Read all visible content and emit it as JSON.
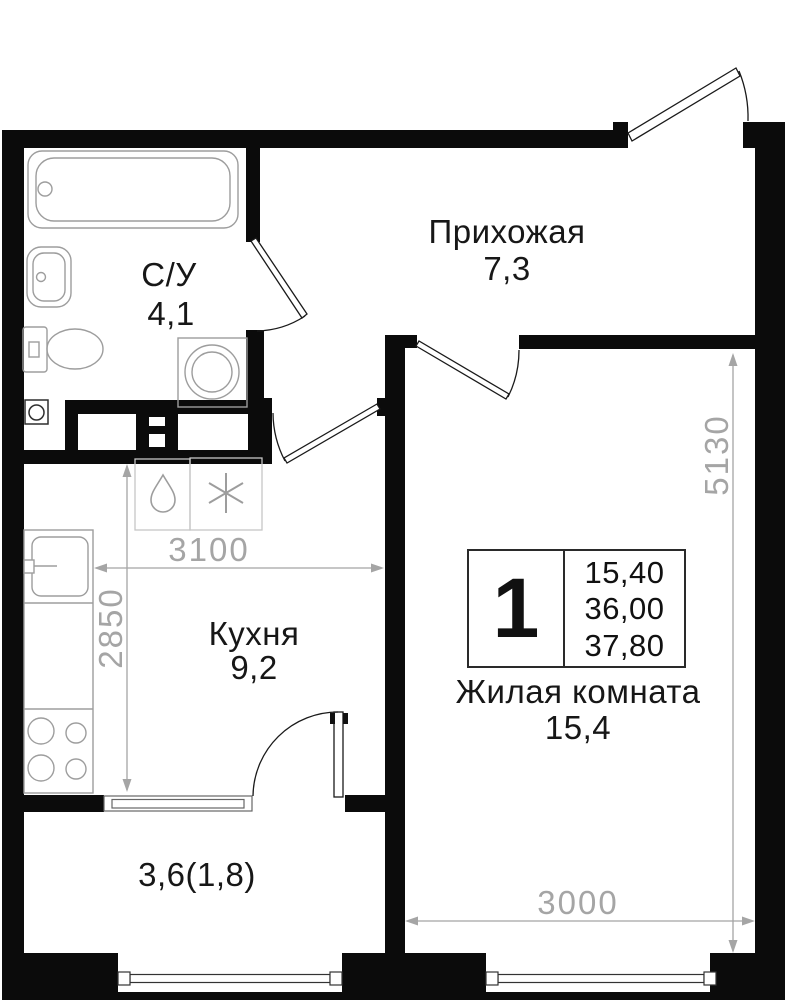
{
  "colors": {
    "wall": "#0b0b0b",
    "fixture_stroke": "#9d9d9d",
    "appliance_stroke": "#c6c6c6",
    "door_stroke": "#1a1a1a",
    "dimension": "#a5a5a5",
    "label_text": "#171717"
  },
  "rooms": {
    "hallway": {
      "name": "Прихожая",
      "area": "7,3"
    },
    "bathroom": {
      "name": "С/У",
      "area": "4,1"
    },
    "kitchen": {
      "name": "Кухня",
      "area": "9,2"
    },
    "living": {
      "name": "Жилая комната",
      "area": "15,4"
    },
    "balcony": {
      "area": "3,6(1,8)"
    }
  },
  "dimensions": {
    "kitchen_width_mm": "3100",
    "kitchen_depth_mm": "2850",
    "living_height_mm": "5130",
    "living_width_mm": "3000"
  },
  "info_box": {
    "room_count": "1",
    "areas": [
      "15,40",
      "36,00",
      "37,80"
    ]
  }
}
